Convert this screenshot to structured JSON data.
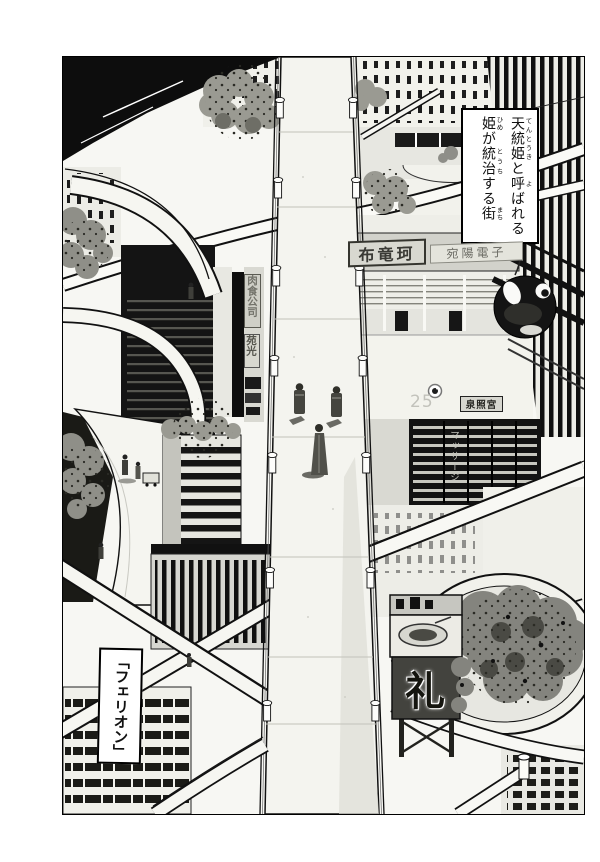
{
  "page_type": "manga cityscape page",
  "narration_box": {
    "plain_text": "天統姫と呼ばれる姫が統治する街",
    "lines": [
      [
        {
          "t": "天統姫",
          "r": "てんとうき"
        },
        {
          "t": "と"
        },
        {
          "t": "呼",
          "r": "よ"
        },
        {
          "t": "ばれる"
        }
      ],
      [
        {
          "t": "姫",
          "r": "ひめ"
        },
        {
          "t": "が"
        },
        {
          "t": "統治",
          "r": "とうち"
        },
        {
          "t": "する"
        },
        {
          "t": "街",
          "r": "まち"
        }
      ]
    ]
  },
  "caption_box": {
    "text": "「フェリオン」"
  },
  "building_signs": {
    "dragon_sign": "布竜珂",
    "electronics_sign": "宛陽電子",
    "company_sign_vertical": "肉食公司",
    "enko_sign_vertical": "苑光",
    "shrine_sign": "泉照宮",
    "massage_sign_vertical": "マッサージ",
    "floor_number": "25",
    "billboard_kanji": "礼"
  },
  "colors": {
    "ink": "#111111",
    "paper": "#ffffff",
    "tone_light": "#ecece6",
    "tone_mid": "#9a9a92",
    "tone_dark": "#45453f",
    "foliage": "#84847e"
  }
}
